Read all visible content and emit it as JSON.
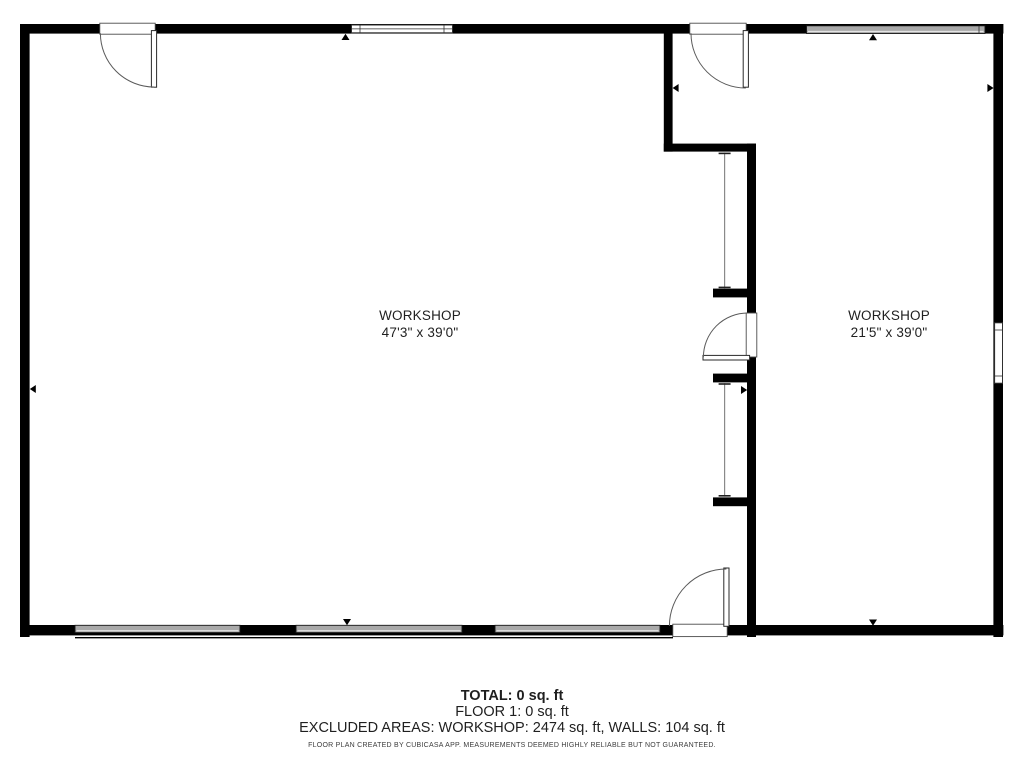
{
  "plan": {
    "rooms": [
      {
        "name": "WORKSHOP",
        "dimensions": "47'3\" x 39'0\""
      },
      {
        "name": "WORKSHOP",
        "dimensions": "21'5\" x 39'0\""
      }
    ],
    "summary": {
      "total": "TOTAL: 0 sq. ft",
      "floor": "FLOOR 1: 0 sq. ft",
      "excluded": "EXCLUDED AREAS: WORKSHOP: 2474 sq. ft, WALLS: 104 sq. ft",
      "disclaimer": "FLOOR PLAN CREATED BY CUBICASA APP. MEASUREMENTS DEEMED HIGHLY RELIABLE BUT NOT GUARANTEED."
    },
    "colors": {
      "wall": "#000000",
      "window_gray": "#a9a9a9",
      "text": "#1f1f1f",
      "muted_text": "#3c3c3c"
    }
  }
}
